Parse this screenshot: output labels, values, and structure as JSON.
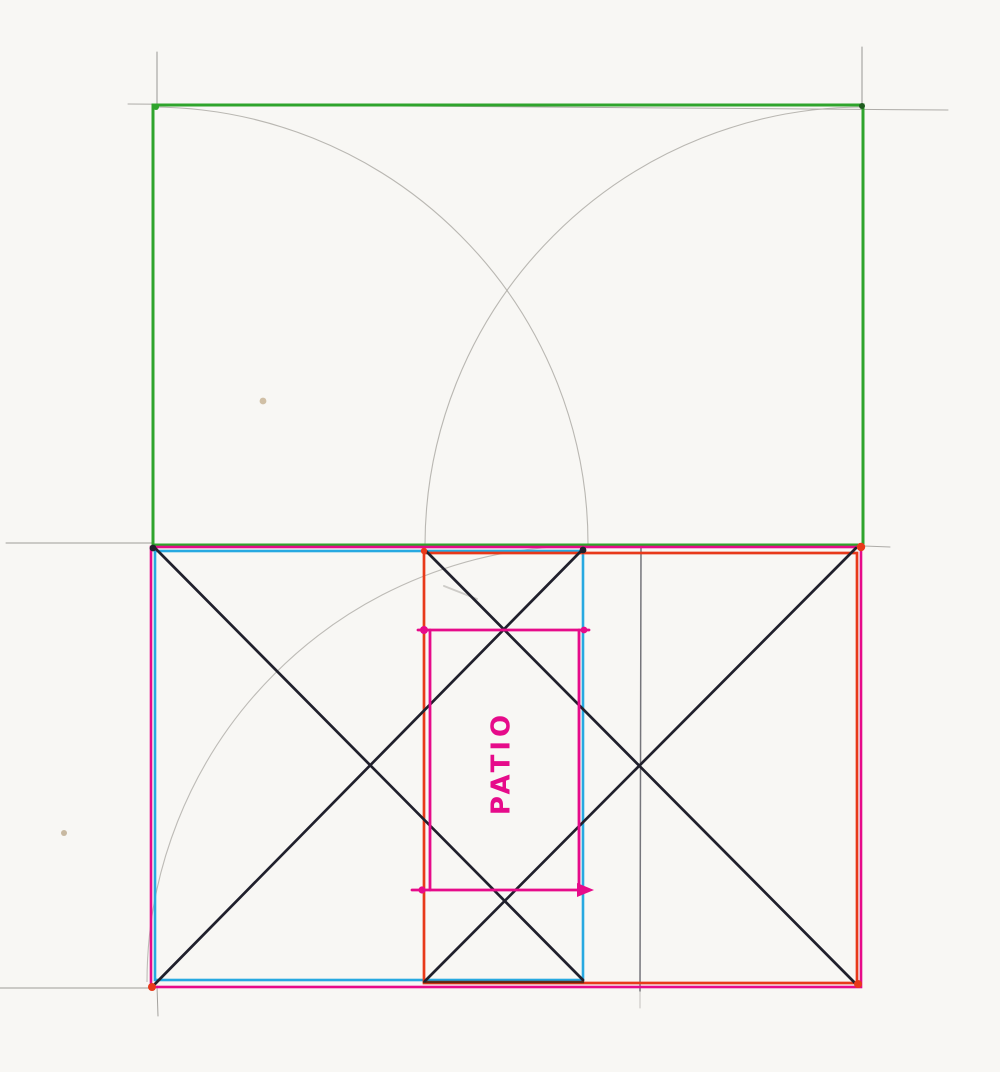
{
  "diagram": {
    "label": "PATIO",
    "canvas": {
      "width": 1000,
      "height": 1072
    },
    "colors": {
      "paper": "#f8f7f4",
      "green": "#2fa42c",
      "magenta": "#e60b8a",
      "cyan": "#27a9e1",
      "red": "#e8391a",
      "ink": "#20202c",
      "pencil": "#8e8c88",
      "arcpencil": "#aeaba6",
      "darkmix": "#55250e",
      "speck": "#c9b596"
    },
    "label_style": {
      "x": 502,
      "y": 763,
      "rotation": -90,
      "size": 26,
      "letter_spacing": 4,
      "color": "magenta"
    },
    "strokes": [
      {
        "t": "line",
        "n": "pencil-top-guide",
        "x1": 128,
        "y1": 104,
        "x2": 948,
        "y2": 110,
        "c": "pencil",
        "w": 1,
        "o": 0.7
      },
      {
        "t": "line",
        "n": "pencil-top-left-vertical",
        "x1": 157,
        "y1": 52,
        "x2": 157,
        "y2": 107,
        "c": "pencil",
        "w": 1,
        "o": 0.9
      },
      {
        "t": "line",
        "n": "pencil-top-right-vertical",
        "x1": 862,
        "y1": 47,
        "x2": 862,
        "y2": 106,
        "c": "pencil",
        "w": 1,
        "o": 0.9
      },
      {
        "t": "line",
        "n": "pencil-mid-left-guide",
        "x1": 6,
        "y1": 543,
        "x2": 152,
        "y2": 543,
        "c": "pencil",
        "w": 1,
        "o": 0.85
      },
      {
        "t": "line",
        "n": "pencil-mid-right-tick",
        "x1": 864,
        "y1": 546,
        "x2": 890,
        "y2": 547,
        "c": "pencil",
        "w": 1,
        "o": 0.7
      },
      {
        "t": "line",
        "n": "pencil-bottom-left-guide",
        "x1": 0,
        "y1": 988,
        "x2": 152,
        "y2": 988,
        "c": "pencil",
        "w": 1,
        "o": 0.85
      },
      {
        "t": "line",
        "n": "pencil-bottom-tick-vertical",
        "x1": 157,
        "y1": 986,
        "x2": 158,
        "y2": 1016,
        "c": "pencil",
        "w": 1,
        "o": 0.8
      },
      {
        "t": "line",
        "n": "pencil-center-vertical",
        "x1": 641,
        "y1": 548,
        "x2": 640,
        "y2": 991,
        "c": "#6e6e74",
        "w": 1.5,
        "o": 0.95
      },
      {
        "t": "line",
        "n": "pencil-center-vertical-tail",
        "x1": 640,
        "y1": 991,
        "x2": 640,
        "y2": 1008,
        "c": "pencil",
        "w": 1,
        "o": 0.5
      },
      {
        "t": "line",
        "n": "pencil-smudge",
        "x1": 444,
        "y1": 586,
        "x2": 477,
        "y2": 599,
        "c": "pencil",
        "w": 2,
        "o": 0.4
      },
      {
        "t": "path",
        "n": "pencil-arc-left",
        "d": "M 152 107 A 437 437 0 0 1 588 545",
        "c": "arcpencil",
        "w": 1.1,
        "o": 0.85
      },
      {
        "t": "path",
        "n": "pencil-arc-right",
        "d": "M 863 107 A 439 439 0 0 0 425 545",
        "c": "arcpencil",
        "w": 1.1,
        "o": 0.85
      },
      {
        "t": "path",
        "n": "pencil-arc-lower",
        "d": "M 583 546 A 436 436 0 0 0 147 982",
        "c": "arcpencil",
        "w": 1.1,
        "o": 0.8
      },
      {
        "t": "rect",
        "n": "green-rectangle",
        "x": 153,
        "y": 105,
        "w": 710,
        "h": 440,
        "c": "green",
        "sw": 3
      },
      {
        "t": "rect",
        "n": "magenta-outer-rectangle",
        "x": 151,
        "y": 547,
        "w": 710,
        "h": 440,
        "c": "magenta",
        "sw": 2.6
      },
      {
        "t": "rect",
        "n": "cyan-rectangle",
        "x": 155,
        "y": 551,
        "w": 428,
        "h": 429,
        "c": "cyan",
        "sw": 2.6
      },
      {
        "t": "rect",
        "n": "red-rectangle",
        "x": 424,
        "y": 553,
        "w": 433,
        "h": 430,
        "c": "red",
        "sw": 2.7
      },
      {
        "t": "line",
        "n": "strip-bottom-dark",
        "x1": 424,
        "y1": 982,
        "x2": 583,
        "y2": 982,
        "c": "darkmix",
        "w": 2.6,
        "o": 0.9
      },
      {
        "t": "line",
        "n": "diagonal-left-down",
        "x1": 154,
        "y1": 547,
        "x2": 583,
        "y2": 980,
        "c": "ink",
        "w": 2.7
      },
      {
        "t": "line",
        "n": "diagonal-left-up",
        "x1": 154,
        "y1": 985,
        "x2": 583,
        "y2": 549,
        "c": "ink",
        "w": 2.7
      },
      {
        "t": "line",
        "n": "diagonal-right-down",
        "x1": 425,
        "y1": 550,
        "x2": 856,
        "y2": 984,
        "c": "ink",
        "w": 2.7
      },
      {
        "t": "line",
        "n": "diagonal-right-up",
        "x1": 425,
        "y1": 981,
        "x2": 856,
        "y2": 548,
        "c": "ink",
        "w": 2.7
      },
      {
        "t": "line",
        "n": "patio-rect-top",
        "x1": 418,
        "y1": 630,
        "x2": 589,
        "y2": 630,
        "c": "magenta",
        "w": 2.8
      },
      {
        "t": "line",
        "n": "patio-rect-bottom",
        "x1": 412,
        "y1": 890,
        "x2": 580,
        "y2": 890,
        "c": "magenta",
        "w": 2.8
      },
      {
        "t": "line",
        "n": "patio-rect-left",
        "x1": 430,
        "y1": 630,
        "x2": 430,
        "y2": 890,
        "c": "magenta",
        "w": 2.8
      },
      {
        "t": "line",
        "n": "patio-rect-right",
        "x1": 579,
        "y1": 630,
        "x2": 579,
        "y2": 890,
        "c": "magenta",
        "w": 2.8
      },
      {
        "t": "dot",
        "n": "patio-top-left-dot",
        "cx": 424,
        "cy": 630,
        "r": 4,
        "c": "magenta"
      },
      {
        "t": "dot",
        "n": "patio-top-right-dot",
        "cx": 584,
        "cy": 630,
        "r": 3.4,
        "c": "magenta"
      },
      {
        "t": "dot",
        "n": "patio-bottom-left-dot",
        "cx": 422,
        "cy": 890,
        "r": 3.6,
        "c": "magenta"
      },
      {
        "t": "poly",
        "n": "patio-bottom-right-arrow",
        "pts": "577,883 594,890 577,897",
        "c": "magenta"
      },
      {
        "t": "dot",
        "n": "corner-dot-bottom-left",
        "cx": 152,
        "cy": 987,
        "r": 4,
        "c": "red"
      },
      {
        "t": "dot",
        "n": "corner-dot-top-right",
        "cx": 861,
        "cy": 547,
        "r": 4.2,
        "c": "red"
      },
      {
        "t": "dot",
        "n": "corner-dot-bottom-right",
        "cx": 858,
        "cy": 984,
        "r": 4,
        "c": "red"
      },
      {
        "t": "dot",
        "n": "corner-dot-top-left",
        "cx": 153,
        "cy": 548,
        "r": 3.4,
        "c": "ink"
      },
      {
        "t": "dot",
        "n": "strip-top-left-dot",
        "cx": 424,
        "cy": 551,
        "r": 3.2,
        "c": "red"
      },
      {
        "t": "dot",
        "n": "strip-top-right-dot",
        "cx": 583,
        "cy": 550,
        "r": 3.4,
        "c": "ink"
      },
      {
        "t": "dot",
        "n": "green-top-left-dot",
        "cx": 156,
        "cy": 107,
        "r": 3,
        "c": "green"
      },
      {
        "t": "dot",
        "n": "green-top-right-dot",
        "cx": 862,
        "cy": 106,
        "r": 3,
        "c": "#1e5c1e"
      },
      {
        "t": "dot",
        "n": "paper-speck-upper",
        "cx": 263,
        "cy": 401,
        "r": 3.4,
        "c": "speck",
        "o": 0.85
      },
      {
        "t": "dot",
        "n": "paper-speck-lower",
        "cx": 64,
        "cy": 833,
        "r": 3,
        "c": "#bfae92",
        "o": 0.85
      }
    ]
  }
}
